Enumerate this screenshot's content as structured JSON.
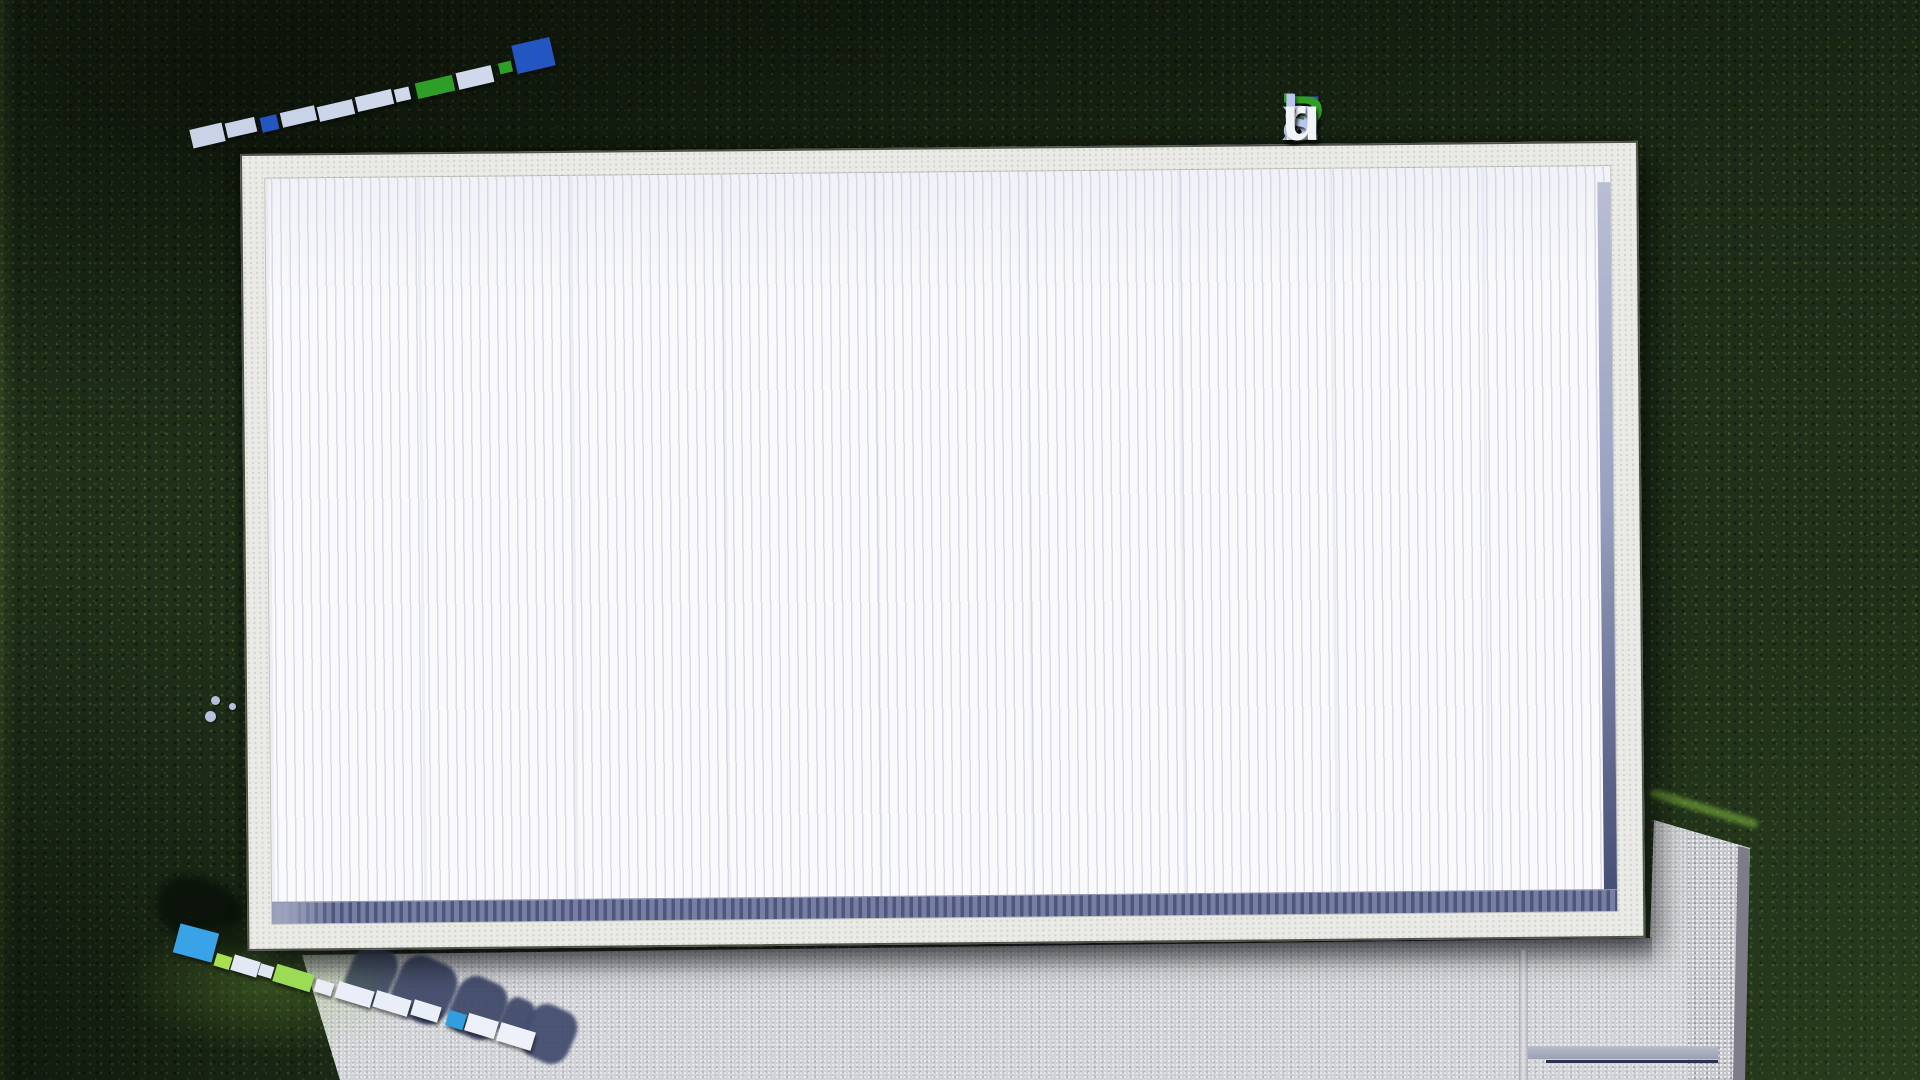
{
  "branding": {
    "logo_text": "FixPlans.ru",
    "segments": [
      {
        "text": "F",
        "color": "#2b5bc7"
      },
      {
        "text": "ı",
        "color": "#b9c5ec",
        "dot": "#2f9e27"
      },
      {
        "text": "x",
        "color": "#b9c5ec"
      },
      {
        "text": "P",
        "color": "#2f9e27"
      },
      {
        "text": "l",
        "color": "#b9c5ec"
      },
      {
        "text": "a",
        "color": "#b9c5ec"
      },
      {
        "text": "n",
        "color": "#b9c5ec"
      },
      {
        "text": "s",
        "color": "#b9c5ec"
      },
      {
        "text": ".",
        "color": "#2453c6"
      },
      {
        "text": "r",
        "color": "#f2f3f7"
      },
      {
        "text": "u",
        "color": "#f2f3f7"
      }
    ]
  },
  "palette": {
    "grass": "#20301a",
    "roof_white": "#fafafc",
    "fascia": "#eaebe6",
    "band_blue": "#535b82",
    "paving": "#d2d3d6",
    "paving_coarse": "#c6c7cb",
    "shadow_navy": "#3d4768",
    "grass_shadow": "#0b130a",
    "outline": "#50534a"
  },
  "watermarks": {
    "top_left_blocks": [
      {
        "x": 191,
        "y": 126,
        "w": 33,
        "h": 19,
        "rot": -13,
        "color": "#c9d3e8"
      },
      {
        "x": 226,
        "y": 120,
        "w": 30,
        "h": 15,
        "rot": -13,
        "color": "#c9d3e8"
      },
      {
        "x": 261,
        "y": 116,
        "w": 17,
        "h": 15,
        "rot": -13,
        "color": "#2356c0"
      },
      {
        "x": 281,
        "y": 109,
        "w": 35,
        "h": 15,
        "rot": -13,
        "color": "#c9d3e8"
      },
      {
        "x": 318,
        "y": 103,
        "w": 36,
        "h": 15,
        "rot": -13,
        "color": "#ccd6ea"
      },
      {
        "x": 356,
        "y": 93,
        "w": 37,
        "h": 15,
        "rot": -13,
        "color": "#d0d8ec"
      },
      {
        "x": 395,
        "y": 88,
        "w": 15,
        "h": 13,
        "rot": -13,
        "color": "#d0d8ec"
      },
      {
        "x": 416,
        "y": 79,
        "w": 38,
        "h": 16,
        "rot": -13,
        "color": "#2f9e27"
      },
      {
        "x": 457,
        "y": 69,
        "w": 36,
        "h": 17,
        "rot": -13,
        "color": "#d0d8ec"
      },
      {
        "x": 499,
        "y": 62,
        "w": 13,
        "h": 11,
        "rot": -13,
        "color": "#2f9e27"
      },
      {
        "x": 514,
        "y": 41,
        "w": 39,
        "h": 29,
        "rot": -13,
        "color": "#2356c0"
      }
    ],
    "bottom_left_blocks": [
      {
        "x": 176,
        "y": 928,
        "w": 40,
        "h": 30,
        "rot": 15,
        "color": "#3aa3e8"
      },
      {
        "x": 215,
        "y": 955,
        "w": 16,
        "h": 13,
        "rot": 17,
        "color": "#a8e050"
      },
      {
        "x": 232,
        "y": 958,
        "w": 27,
        "h": 16,
        "rot": 17,
        "color": "#e3e9f4"
      },
      {
        "x": 259,
        "y": 965,
        "w": 14,
        "h": 12,
        "rot": 17,
        "color": "#dfe6f2"
      },
      {
        "x": 274,
        "y": 969,
        "w": 39,
        "h": 18,
        "rot": 17,
        "color": "#9bdb56"
      },
      {
        "x": 315,
        "y": 981,
        "w": 18,
        "h": 13,
        "rot": 17,
        "color": "#e8edf6"
      },
      {
        "x": 336,
        "y": 986,
        "w": 37,
        "h": 17,
        "rot": 17,
        "color": "#eaeef8"
      },
      {
        "x": 374,
        "y": 995,
        "w": 36,
        "h": 17,
        "rot": 17,
        "color": "#eaeef8"
      },
      {
        "x": 412,
        "y": 1003,
        "w": 28,
        "h": 16,
        "rot": 17,
        "color": "#eaeef8"
      },
      {
        "x": 447,
        "y": 1012,
        "w": 18,
        "h": 16,
        "rot": 17,
        "color": "#2f9fe0"
      },
      {
        "x": 466,
        "y": 1017,
        "w": 31,
        "h": 18,
        "rot": 17,
        "color": "#edf0f9"
      },
      {
        "x": 498,
        "y": 1027,
        "w": 36,
        "h": 19,
        "rot": 17,
        "color": "#eef1fa"
      }
    ],
    "paving_shadow_blobs": [
      {
        "x": 348,
        "y": 946,
        "w": 46,
        "h": 60,
        "rot": 24,
        "color": "#3d4768"
      },
      {
        "x": 394,
        "y": 958,
        "w": 60,
        "h": 64,
        "rot": 24,
        "color": "#3d4768"
      },
      {
        "x": 452,
        "y": 978,
        "w": 52,
        "h": 60,
        "rot": 24,
        "color": "#3d4768"
      },
      {
        "x": 502,
        "y": 998,
        "w": 30,
        "h": 40,
        "rot": 24,
        "color": "#3d4768"
      },
      {
        "x": 524,
        "y": 1006,
        "w": 50,
        "h": 56,
        "rot": 24,
        "color": "#404a6c"
      }
    ],
    "grass_shadow_blobs": [
      {
        "x": 156,
        "y": 878,
        "w": 86,
        "h": 62,
        "rot": 18,
        "color": "#0b130a"
      },
      {
        "x": 204,
        "y": 928,
        "w": 44,
        "h": 28,
        "rot": 18,
        "color": "#0b130a"
      }
    ]
  },
  "details": {
    "vent_dots": [
      {
        "x": 211,
        "y": 696,
        "s": 9
      },
      {
        "x": 205,
        "y": 711,
        "s": 11
      },
      {
        "x": 229,
        "y": 703,
        "s": 7
      }
    ]
  }
}
